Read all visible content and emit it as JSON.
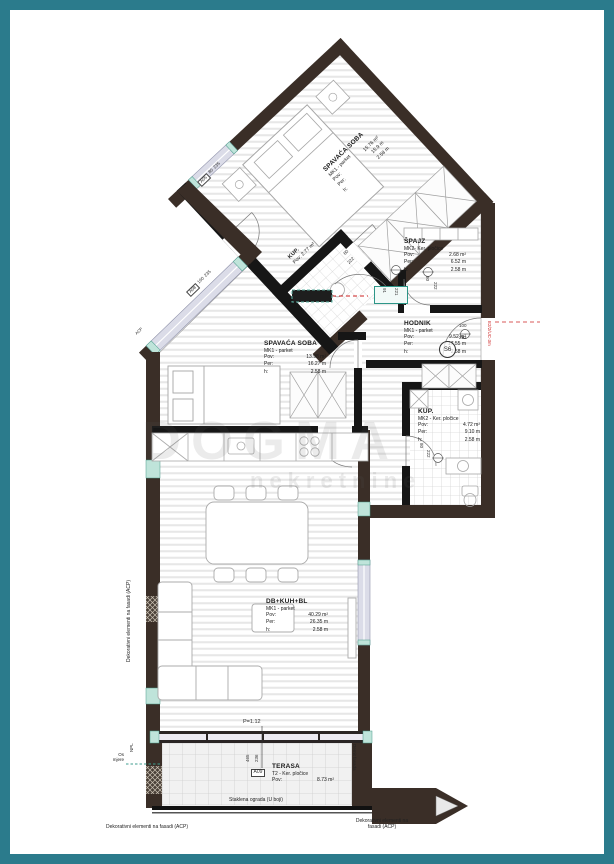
{
  "page": {
    "frame_color": "#2b7b8c",
    "background": "#ffffff"
  },
  "watermark": {
    "line1": "DOGMA",
    "line2": "nekretnine"
  },
  "field_labels": {
    "pov": "Pov:",
    "per": "Per:",
    "h": "h:"
  },
  "rooms": [
    {
      "name": "SPAVAĆA SOBA",
      "finish": "MK1 - parket",
      "pov": "15.76 m²",
      "per": "15.9 m",
      "h": "2.58 m"
    },
    {
      "name": "ŠPAJZ",
      "finish": "MK2- Ker. pločice",
      "pov": "2.68 m²",
      "per": "6.52 m",
      "h": "2.58 m"
    },
    {
      "name": "HODNIK",
      "finish": "MK1 - parket",
      "pov": "9.52 m²",
      "per": "17.55 m",
      "h": "2.58 m"
    },
    {
      "name": "KUP.",
      "finish": "MK2 - Ker. pločice",
      "pov": "4.72 m²",
      "per": "9.10 m",
      "h": "2.58 m"
    },
    {
      "name": "SPAVAĆA SOBA",
      "finish": "MK1 - parket",
      "pov": "13.98 m²",
      "per": "16.27 m",
      "h": "2.58 m"
    },
    {
      "name": "DB+KUH+BL",
      "finish": "MK1 - parket",
      "pov": "40.29 m²",
      "per": "26.35 m",
      "h": "2.58 m"
    },
    {
      "name": "TERASA",
      "finish": "T2 - Ker. pločice",
      "pov": "8.73 m²"
    }
  ],
  "mini_room": {
    "name": "KUP.",
    "pov": "Pov: 2.77 m²"
  },
  "doors": {
    "spajz": {
      "w": "80",
      "h": "222"
    },
    "hodnik": {
      "w": "100",
      "h": "222"
    },
    "kup": {
      "w": "80",
      "h": "222"
    },
    "mini": {
      "w": "80",
      "h": "222"
    },
    "entry": {
      "w": "91",
      "h": "221"
    }
  },
  "windows": {
    "a05": {
      "mark": "A05",
      "w": "80",
      "h": "235"
    },
    "a08": {
      "mark": "A08",
      "w": "160",
      "h": "235"
    },
    "a09": {
      "mark": "A09",
      "d1": "465",
      "d2": "236",
      "parapet": "P=1.12"
    }
  },
  "codes": {
    "room_tag": "S6",
    "unit": "E2/2/UC-3m"
  },
  "notes": {
    "glass_railing": "Staklena ograda (U boji)",
    "deco_facade_left": "Dekorativni elementi na fasadi (ACP)",
    "deco_facade_bottom_left": "Dekorativni elementi na fasadi (ACP)",
    "deco_facade_bottom_right_1": "Dekorativni elementi na",
    "deco_facade_bottom_right_2": "fasadi (ACP)",
    "demit": "Demit fasada",
    "npl": "NPL",
    "os_1": "Os",
    "os_2": "mjere",
    "acp": "ACP"
  },
  "colors": {
    "frame": "#2b7b8c",
    "wall_exterior": "#3a2e27",
    "wall_interior": "#161616",
    "window_fill": "#dbdce8",
    "accent_teal": "#bfe4da",
    "marker_red": "#cc2222",
    "parquet_stripe": "#e7e7e7"
  }
}
